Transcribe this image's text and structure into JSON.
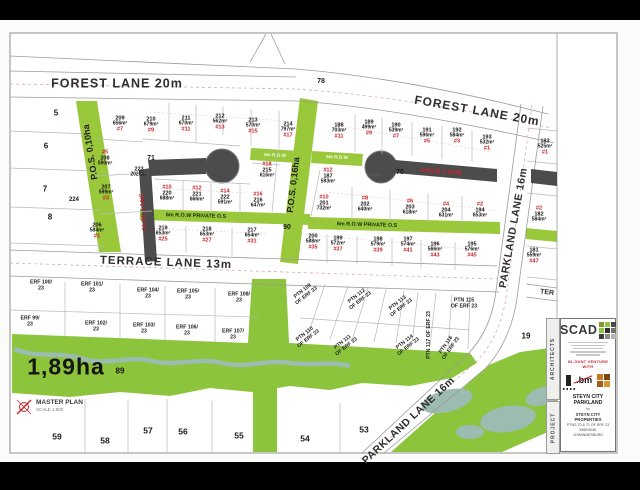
{
  "colors": {
    "pos_green": "#9ac83b",
    "park_green": "#8cc43c",
    "stream": "#9cbbb1",
    "road_dark": "#4c4c4c",
    "accent_red": "#c4262e"
  },
  "legend": {
    "title": "MASTER PLAN",
    "scale": "SCALE 1:500"
  },
  "title_block": {
    "spine_architects": "ARCHITECTS",
    "spine_project": "PROJECT",
    "firm": "SCAD",
    "logo_squares": [
      "#7d9930",
      "#8dc63f",
      "#474746",
      "#8dc63f",
      "#2f2f2e",
      "#6f6f6e",
      "#3d3d3c",
      "#8a8a89",
      "#b5b5b4"
    ],
    "joint_venture": "IN JOINT VENTURE WITH",
    "partner_bm": ".bm",
    "partner_squares": [
      "#c8761f",
      "#7d430f",
      "#a65c16",
      "#d9952e"
    ],
    "project_name": "STEYN CITY PARKLAND",
    "for_text": "for",
    "client": "STEYN CITY PROPERTIES",
    "detail_1": "PTNS 70 & 71 OF ERF 23",
    "detail_2": "MIDRAND",
    "detail_3": "JOHANNESBURG"
  },
  "map": {
    "labels": [
      {
        "kind": "road",
        "name": "forest-lane-west-label",
        "t": "FOREST LANE 20m",
        "x": 117,
        "y": 84,
        "size": 12.5,
        "ls": 1,
        "rot": 0
      },
      {
        "kind": "road",
        "name": "forest-lane-east-label",
        "t": "FOREST LANE 20m",
        "x": 477,
        "y": 111,
        "size": 12,
        "ls": 1,
        "rot": 10
      },
      {
        "kind": "road",
        "name": "terrace-lane-label",
        "t": "TERRACE LANE 13m",
        "x": 166,
        "y": 263,
        "size": 11.5,
        "ls": 1,
        "rot": 2
      },
      {
        "kind": "road",
        "name": "parkland-lane-label",
        "t": "PARKLAND LANE 16m",
        "x": 514,
        "y": 228,
        "size": 10.5,
        "ls": 0.5,
        "rot": -80
      },
      {
        "kind": "road",
        "name": "parkland-lane-south-label",
        "t": "PARKLAND LANE 16m",
        "x": 409,
        "y": 421,
        "size": 10.5,
        "ls": 0.5,
        "rot": -43
      },
      {
        "kind": "road",
        "name": "terrace-lane-east-clip-label",
        "t": "TER",
        "x": 547,
        "y": 293,
        "size": 7,
        "rot": 7
      },
      {
        "kind": "lane-red",
        "name": "aloe-lane-label",
        "t": "ALOE LANE",
        "x": 144,
        "y": 212,
        "size": 6,
        "rot": -94
      },
      {
        "kind": "lane-red",
        "name": "arum-lane-label",
        "t": "ARUM LANE",
        "x": 441,
        "y": 172,
        "size": 6.5,
        "rot": 4
      },
      {
        "kind": "green-label",
        "name": "pos-010ha-label",
        "t": "P.O.S. 0,10ha",
        "x": 91,
        "y": 152,
        "size": 9,
        "rot": -99
      },
      {
        "kind": "green-label",
        "name": "pos-016ha-label",
        "t": "P.O.S. 0,16ha",
        "x": 294,
        "y": 185,
        "size": 9,
        "rot": -83
      },
      {
        "kind": "band-white",
        "name": "row-west-label",
        "t": "6m R.O.W",
        "x": 275,
        "y": 156,
        "size": 4.6,
        "rot": 3
      },
      {
        "kind": "band-white",
        "name": "row-east-label",
        "t": "6m R.O.W",
        "x": 337,
        "y": 158,
        "size": 4.6,
        "rot": 3
      },
      {
        "kind": "band-dark",
        "name": "row-private-west-label",
        "t": "6m R.O.W PRIVATE O.S",
        "x": 196,
        "y": 217,
        "size": 5.4,
        "rot": 1.5
      },
      {
        "kind": "band-dark",
        "name": "row-private-east-label",
        "t": "6m R.O.W PRIVATE O.S",
        "x": 367,
        "y": 226,
        "size": 5.4,
        "rot": 1.5
      },
      {
        "kind": "number",
        "name": "plot-5",
        "t": "5",
        "x": 56,
        "y": 114,
        "size": 8
      },
      {
        "kind": "number",
        "name": "plot-6",
        "t": "6",
        "x": 46,
        "y": 147,
        "size": 8
      },
      {
        "kind": "number",
        "name": "plot-7",
        "t": "7",
        "x": 45,
        "y": 190,
        "size": 8
      },
      {
        "kind": "number",
        "name": "plot-8",
        "t": "8",
        "x": 50,
        "y": 218,
        "size": 8
      },
      {
        "kind": "number",
        "name": "portion-78",
        "t": "78",
        "x": 321,
        "y": 82,
        "size": 7
      },
      {
        "kind": "number",
        "name": "portion-71",
        "t": "71",
        "x": 151,
        "y": 159,
        "size": 7
      },
      {
        "kind": "number",
        "name": "portion-70",
        "t": "70",
        "x": 400,
        "y": 173,
        "size": 7
      },
      {
        "kind": "number",
        "name": "portion-90",
        "t": "90",
        "x": 287,
        "y": 228,
        "size": 7
      },
      {
        "kind": "number",
        "name": "portion-224",
        "t": "224",
        "x": 74,
        "y": 200,
        "size": 6
      },
      {
        "kind": "number",
        "name": "portion-89",
        "t": "89",
        "x": 120,
        "y": 372,
        "size": 8
      },
      {
        "kind": "number",
        "name": "plot-19",
        "t": "19",
        "x": 526,
        "y": 337,
        "size": 8
      },
      {
        "kind": "number",
        "name": "culdesac-area",
        "t": "1494m²",
        "x": 375,
        "y": 176,
        "size": 4.6,
        "color": "#5a5a5a"
      },
      {
        "kind": "big",
        "name": "park-area-label",
        "t": "1,89ha",
        "x": 66,
        "y": 367,
        "size": 23
      },
      {
        "kind": "number",
        "name": "erf-59",
        "t": "59",
        "x": 57,
        "y": 437,
        "size": 8.5
      },
      {
        "kind": "number",
        "name": "erf-58",
        "t": "58",
        "x": 105,
        "y": 441,
        "size": 8.5
      },
      {
        "kind": "number",
        "name": "erf-57",
        "t": "57",
        "x": 148,
        "y": 431,
        "size": 8.5
      },
      {
        "kind": "number",
        "name": "erf-56",
        "t": "56",
        "x": 183,
        "y": 432,
        "size": 8.5
      },
      {
        "kind": "number",
        "name": "erf-55",
        "t": "55",
        "x": 239,
        "y": 436,
        "size": 8.5
      },
      {
        "kind": "number",
        "name": "erf-54",
        "t": "54",
        "x": 305,
        "y": 439,
        "size": 8.5
      },
      {
        "kind": "number",
        "name": "erf-53",
        "t": "53",
        "x": 364,
        "y": 430,
        "size": 8.5
      },
      {
        "kind": "lot",
        "name": "lot-209",
        "erf": "209",
        "area": "656m²",
        "tag": "#7",
        "tagPos": "below",
        "x": 120,
        "y": 124
      },
      {
        "kind": "lot",
        "name": "lot-210",
        "erf": "210",
        "area": "679m²",
        "tag": "#9",
        "tagPos": "below",
        "x": 151,
        "y": 125
      },
      {
        "kind": "lot",
        "name": "lot-211",
        "erf": "211",
        "area": "670m²",
        "tag": "#11",
        "tagPos": "below",
        "x": 186,
        "y": 124
      },
      {
        "kind": "lot",
        "name": "lot-212",
        "erf": "212",
        "area": "562m²",
        "tag": "#13",
        "tagPos": "below",
        "x": 220,
        "y": 122
      },
      {
        "kind": "lot",
        "name": "lot-213",
        "erf": "213",
        "area": "570m²",
        "tag": "#15",
        "tagPos": "below",
        "x": 253,
        "y": 126
      },
      {
        "kind": "lot",
        "name": "lot-214",
        "erf": "214",
        "area": "797m²",
        "tag": "#17",
        "tagPos": "below",
        "x": 288,
        "y": 130
      },
      {
        "kind": "lot",
        "name": "lot-208",
        "erf": "208",
        "area": "590m²",
        "tag": "#5",
        "tagPos": "above",
        "x": 105,
        "y": 158
      },
      {
        "kind": "lot",
        "name": "lot-207",
        "erf": "207",
        "area": "599m²",
        "tag": "#3",
        "tagPos": "below",
        "x": 106,
        "y": 193
      },
      {
        "kind": "lot",
        "name": "lot-206",
        "erf": "206",
        "area": "584m²",
        "tag": "#1",
        "tagPos": "below",
        "x": 97,
        "y": 231
      },
      {
        "kind": "lot",
        "name": "lot-223",
        "erf": "223",
        "area": "2025m²",
        "tag": "",
        "tagPos": "below",
        "x": 139,
        "y": 172
      },
      {
        "kind": "lot",
        "name": "lot-220",
        "erf": "220",
        "area": "688m²",
        "tag": "#10",
        "tagPos": "above",
        "x": 167,
        "y": 193
      },
      {
        "kind": "lot",
        "name": "lot-221",
        "erf": "221",
        "area": "666m²",
        "tag": "#12",
        "tagPos": "above",
        "x": 197,
        "y": 194
      },
      {
        "kind": "lot",
        "name": "lot-222",
        "erf": "222",
        "area": "591m²",
        "tag": "#14",
        "tagPos": "above",
        "x": 225,
        "y": 197
      },
      {
        "kind": "lot",
        "name": "lot-216",
        "erf": "216",
        "area": "647m²",
        "tag": "#16",
        "tagPos": "above",
        "x": 258,
        "y": 200
      },
      {
        "kind": "lot",
        "name": "lot-215",
        "erf": "215",
        "area": "616m²",
        "tag": "#18",
        "tagPos": "above",
        "x": 267,
        "y": 170
      },
      {
        "kind": "lot",
        "name": "lot-219",
        "erf": "219",
        "area": "653m²",
        "tag": "#25",
        "tagPos": "below",
        "x": 163,
        "y": 234
      },
      {
        "kind": "lot",
        "name": "lot-218",
        "erf": "218",
        "area": "653m²",
        "tag": "#27",
        "tagPos": "below",
        "x": 207,
        "y": 235
      },
      {
        "kind": "lot",
        "name": "lot-217",
        "erf": "217",
        "area": "654m²",
        "tag": "#31",
        "tagPos": "below",
        "x": 252,
        "y": 236
      },
      {
        "kind": "lot",
        "name": "lot-188",
        "erf": "188",
        "area": "703m²",
        "tag": "#11",
        "tagPos": "below",
        "x": 339,
        "y": 131
      },
      {
        "kind": "lot",
        "name": "lot-189",
        "erf": "189",
        "area": "499m²",
        "tag": "#9",
        "tagPos": "below",
        "x": 369,
        "y": 128
      },
      {
        "kind": "lot",
        "name": "lot-190",
        "erf": "190",
        "area": "539m²",
        "tag": "#7",
        "tagPos": "below",
        "x": 396,
        "y": 131
      },
      {
        "kind": "lot",
        "name": "lot-191",
        "erf": "191",
        "area": "596m²",
        "tag": "#5",
        "tagPos": "below",
        "x": 427,
        "y": 136
      },
      {
        "kind": "lot",
        "name": "lot-192",
        "erf": "192",
        "area": "584m²",
        "tag": "#3",
        "tagPos": "below",
        "x": 457,
        "y": 136
      },
      {
        "kind": "lot",
        "name": "lot-193",
        "erf": "193",
        "area": "532m²",
        "tag": "#1",
        "tagPos": "below",
        "x": 487,
        "y": 143
      },
      {
        "kind": "lot",
        "name": "lot-187",
        "erf": "187",
        "area": "593m²",
        "tag": "#12",
        "tagPos": "above",
        "x": 328,
        "y": 176
      },
      {
        "kind": "lot",
        "name": "lot-201",
        "erf": "201",
        "area": "732m²",
        "tag": "#10",
        "tagPos": "above",
        "x": 324,
        "y": 203
      },
      {
        "kind": "lot",
        "name": "lot-202",
        "erf": "202",
        "area": "640m²",
        "tag": "#8",
        "tagPos": "above",
        "x": 365,
        "y": 204
      },
      {
        "kind": "lot",
        "name": "lot-203",
        "erf": "203",
        "area": "618m²",
        "tag": "#6",
        "tagPos": "above",
        "x": 410,
        "y": 207
      },
      {
        "kind": "lot",
        "name": "lot-204",
        "erf": "204",
        "area": "631m²",
        "tag": "#4",
        "tagPos": "above",
        "x": 446,
        "y": 210
      },
      {
        "kind": "lot",
        "name": "lot-194",
        "erf": "194",
        "area": "653m²",
        "tag": "#2",
        "tagPos": "above",
        "x": 480,
        "y": 210
      },
      {
        "kind": "lot",
        "name": "lot-200",
        "erf": "200",
        "area": "588m²",
        "tag": "#35",
        "tagPos": "below",
        "x": 313,
        "y": 242
      },
      {
        "kind": "lot",
        "name": "lot-199",
        "erf": "199",
        "area": "572m²",
        "tag": "#37",
        "tagPos": "below",
        "x": 338,
        "y": 244
      },
      {
        "kind": "lot",
        "name": "lot-198",
        "erf": "198",
        "area": "579m²",
        "tag": "#39",
        "tagPos": "below",
        "x": 378,
        "y": 245
      },
      {
        "kind": "lot",
        "name": "lot-197",
        "erf": "197",
        "area": "574m²",
        "tag": "#41",
        "tagPos": "below",
        "x": 408,
        "y": 245
      },
      {
        "kind": "lot",
        "name": "lot-196",
        "erf": "196",
        "area": "566m²",
        "tag": "#43",
        "tagPos": "below",
        "x": 435,
        "y": 250
      },
      {
        "kind": "lot",
        "name": "lot-195",
        "erf": "195",
        "area": "576m²",
        "tag": "#45",
        "tagPos": "below",
        "x": 472,
        "y": 250
      },
      {
        "kind": "lot",
        "name": "lot-183",
        "erf": "183",
        "area": "525m²",
        "tag": "#1",
        "tagPos": "below",
        "x": 545,
        "y": 147
      },
      {
        "kind": "lot",
        "name": "lot-182",
        "erf": "182",
        "area": "584m²",
        "tag": "#2",
        "tagPos": "above",
        "x": 539,
        "y": 214
      },
      {
        "kind": "lot",
        "name": "lot-181",
        "erf": "181",
        "area": "559m²",
        "tag": "#47",
        "tagPos": "below",
        "x": 534,
        "y": 256
      },
      {
        "kind": "parcel",
        "name": "parcel-erf-100-23",
        "l1": "ERF 100/",
        "l2": "23",
        "x": 41,
        "y": 286,
        "rot": 0
      },
      {
        "kind": "parcel",
        "name": "parcel-erf-101-23",
        "l1": "ERF 101/",
        "l2": "23",
        "x": 92,
        "y": 288,
        "rot": 0
      },
      {
        "kind": "parcel",
        "name": "parcel-erf-104-23",
        "l1": "ERF 104/",
        "l2": "23",
        "x": 148,
        "y": 294,
        "rot": 0
      },
      {
        "kind": "parcel",
        "name": "parcel-erf-105-23",
        "l1": "ERF 105/",
        "l2": "23",
        "x": 188,
        "y": 295,
        "rot": 0
      },
      {
        "kind": "parcel",
        "name": "parcel-erf-108-23",
        "l1": "ERF 108/",
        "l2": "23",
        "x": 239,
        "y": 298,
        "rot": 0
      },
      {
        "kind": "parcel",
        "name": "parcel-erf-99-23",
        "l1": "ERF 99/",
        "l2": "23",
        "x": 30,
        "y": 322,
        "rot": 0
      },
      {
        "kind": "parcel",
        "name": "parcel-erf-102-23",
        "l1": "ERF 102/",
        "l2": "23",
        "x": 96,
        "y": 327,
        "rot": 0
      },
      {
        "kind": "parcel",
        "name": "parcel-erf-103-23",
        "l1": "ERF 103/",
        "l2": "23",
        "x": 144,
        "y": 329,
        "rot": 0
      },
      {
        "kind": "parcel",
        "name": "parcel-erf-106-23",
        "l1": "ERF 106/",
        "l2": "23",
        "x": 187,
        "y": 331,
        "rot": 0
      },
      {
        "kind": "parcel",
        "name": "parcel-erf-107-23",
        "l1": "ERF 107/",
        "l2": "23",
        "x": 233,
        "y": 335,
        "rot": 0
      },
      {
        "kind": "parcel",
        "name": "parcel-ptn-109",
        "l1": "PTN 109",
        "l2": "OF ERF 23",
        "x": 305,
        "y": 294,
        "rot": -38
      },
      {
        "kind": "parcel",
        "name": "parcel-ptn-112",
        "l1": "PTN 112",
        "l2": "OF ERF 23",
        "x": 359,
        "y": 299,
        "rot": -38
      },
      {
        "kind": "parcel",
        "name": "parcel-ptn-113",
        "l1": "PTN 113",
        "l2": "OF ERF 23",
        "x": 400,
        "y": 306,
        "rot": -38
      },
      {
        "kind": "parcel",
        "name": "parcel-ptn-115",
        "l1": "PTN 115",
        "l2": "OF ERF 23",
        "x": 464,
        "y": 304,
        "rot": 0
      },
      {
        "kind": "parcel",
        "name": "parcel-ptn-110",
        "l1": "PTN 110",
        "l2": "OF ERF 23",
        "x": 307,
        "y": 337,
        "rot": -38
      },
      {
        "kind": "parcel",
        "name": "parcel-ptn-111",
        "l1": "PTN 111",
        "l2": "OF ERF 23",
        "x": 345,
        "y": 345,
        "rot": -38
      },
      {
        "kind": "parcel",
        "name": "parcel-ptn-114",
        "l1": "PTN 114",
        "l2": "OF ERF 23",
        "x": 407,
        "y": 345,
        "rot": -38
      },
      {
        "kind": "parcel",
        "name": "parcel-ptn-117",
        "l1": "PTN 117 OF ERF 23",
        "l2": "",
        "x": 430,
        "y": 335,
        "rot": -90
      },
      {
        "kind": "parcel",
        "name": "parcel-ptn-116",
        "l1": "PTN 116",
        "l2": "OF ERF 23",
        "x": 449,
        "y": 347,
        "rot": -55
      }
    ]
  }
}
